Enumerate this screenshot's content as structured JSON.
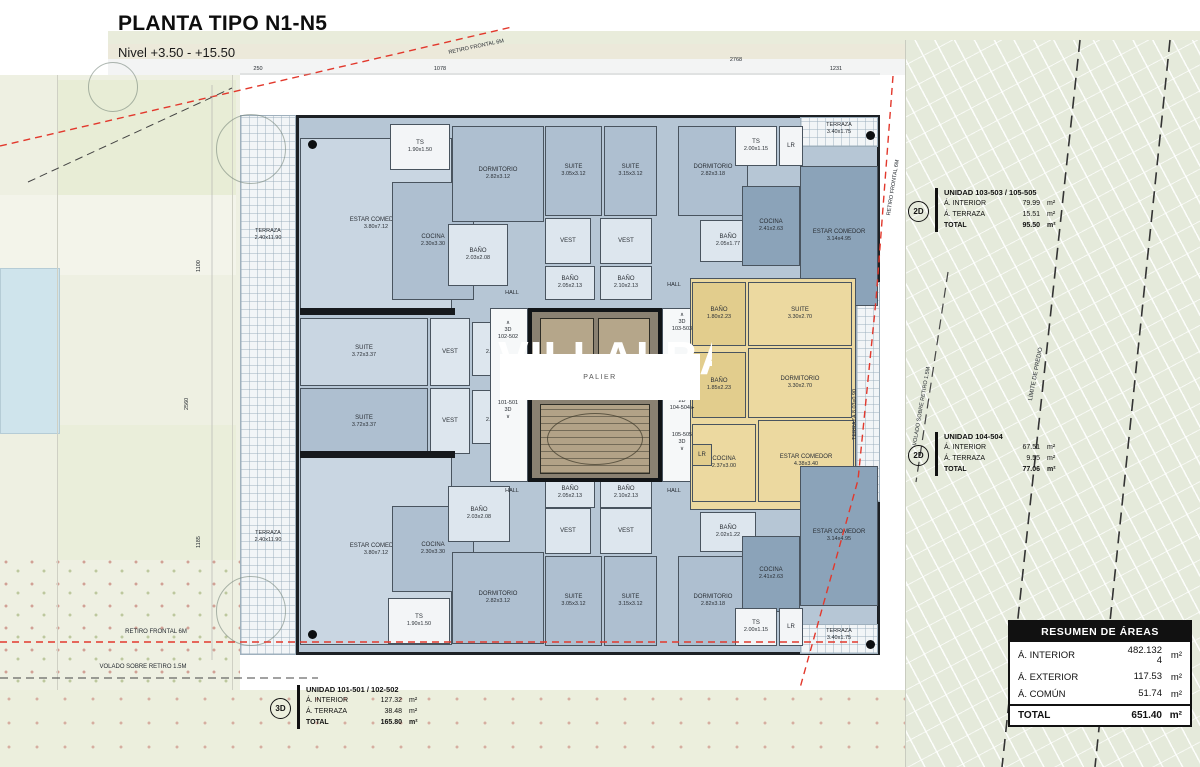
{
  "title": "PLANTA TIPO N1-N5",
  "subtitle": "Nivel +3.50 - +15.50",
  "watermark": "VILLALBA",
  "colors": {
    "fills": {
      "lb": "#c9d6e2",
      "mb": "#aebfd0",
      "db": "#8ba3b9",
      "wb": "#dde6ee",
      "yl": "#ecd9a0",
      "yd": "#e2cd8d",
      "wh": "#f3f5f7",
      "ht": "#f6f8f9"
    },
    "red_setback": "#e2382c",
    "wall": "#1d2125",
    "yellow_unit": "#ecd9a0",
    "blue_unit": "#aebfd0"
  },
  "core": {
    "elev1": "A01",
    "elev2": "A02",
    "palier": "PALIER"
  },
  "plan": {
    "terraces": [
      [
        240,
        115,
        56,
        540
      ],
      [
        800,
        117,
        78,
        30
      ],
      [
        800,
        624,
        78,
        30
      ],
      [
        856,
        282,
        24,
        220
      ]
    ],
    "rooms": [
      [
        300,
        138,
        152,
        172,
        "lb",
        "ESTAR COMEDOR",
        "3.80x7.12"
      ],
      [
        390,
        124,
        60,
        46,
        "wh",
        "TS",
        "1.90x1.50"
      ],
      [
        392,
        182,
        82,
        118,
        "mb",
        "COCINA",
        "2.30x3.30"
      ],
      [
        452,
        126,
        92,
        96,
        "mb",
        "DORMITORIO",
        "2.82x3.12"
      ],
      [
        448,
        224,
        60,
        62,
        "wb",
        "BAÑO",
        "2.03x2.08"
      ],
      [
        545,
        126,
        57,
        90,
        "mb",
        "SUITE",
        "3.05x3.12"
      ],
      [
        604,
        126,
        53,
        90,
        "mb",
        "SUITE",
        "3.15x3.12"
      ],
      [
        678,
        126,
        70,
        90,
        "mb",
        "DORMITORIO",
        "2.82x3.18"
      ],
      [
        545,
        218,
        46,
        46,
        "wb",
        "VEST",
        ""
      ],
      [
        600,
        218,
        52,
        46,
        "wb",
        "VEST",
        ""
      ],
      [
        545,
        266,
        50,
        34,
        "wb",
        "BAÑO",
        "2.05x2.13"
      ],
      [
        600,
        266,
        52,
        34,
        "wb",
        "BAÑO",
        "2.10x2.13"
      ],
      [
        700,
        220,
        56,
        42,
        "wb",
        "BAÑO",
        "2.05x1.77"
      ],
      [
        735,
        126,
        42,
        40,
        "wh",
        "TS",
        "2.00x1.15"
      ],
      [
        779,
        126,
        24,
        40,
        "wh",
        "LR",
        ""
      ],
      [
        742,
        186,
        58,
        80,
        "db",
        "COCINA",
        "2.41x2.63"
      ],
      [
        800,
        166,
        78,
        140,
        "db",
        "ESTAR COMEDOR",
        "3.14x4.95"
      ],
      [
        300,
        318,
        128,
        68,
        "lb",
        "SUITE",
        "3.72x3.37"
      ],
      [
        300,
        388,
        128,
        68,
        "mb",
        "SUITE",
        "3.72x3.37"
      ],
      [
        430,
        318,
        40,
        68,
        "wb",
        "VEST",
        ""
      ],
      [
        430,
        388,
        40,
        66,
        "wb",
        "VEST",
        ""
      ],
      [
        472,
        322,
        52,
        54,
        "wb",
        "BAÑO",
        "2.23x2.17"
      ],
      [
        472,
        390,
        52,
        54,
        "wb",
        "BAÑO",
        "2.23x2.17"
      ],
      [
        490,
        308,
        38,
        174,
        "ht",
        "",
        ""
      ],
      [
        662,
        308,
        30,
        174,
        "ht",
        "",
        ""
      ],
      [
        690,
        278,
        166,
        232,
        "yl",
        "",
        ""
      ],
      [
        692,
        282,
        54,
        64,
        "yd",
        "BAÑO",
        "1.80x2.23"
      ],
      [
        748,
        282,
        104,
        64,
        "yl",
        "SUITE",
        "3.30x2.70"
      ],
      [
        692,
        352,
        54,
        66,
        "yd",
        "BAÑO",
        "1.85x2.23"
      ],
      [
        748,
        348,
        104,
        70,
        "yl",
        "DORMITORIO",
        "3.30x2.70"
      ],
      [
        692,
        424,
        64,
        78,
        "yl",
        "COCINA",
        "2.37x3.00"
      ],
      [
        758,
        420,
        96,
        82,
        "yl",
        "ESTAR COMEDOR",
        "4.38x3.40"
      ],
      [
        692,
        444,
        20,
        22,
        "yd",
        "LR",
        ""
      ],
      [
        300,
        455,
        152,
        190,
        "lb",
        "ESTAR COMEDOR",
        "3.80x7.12"
      ],
      [
        392,
        506,
        82,
        86,
        "mb",
        "COCINA",
        "2.30x3.30"
      ],
      [
        448,
        486,
        62,
        56,
        "wb",
        "BAÑO",
        "2.03x2.08"
      ],
      [
        388,
        598,
        62,
        46,
        "wh",
        "TS",
        "1.90x1.50"
      ],
      [
        452,
        552,
        92,
        92,
        "mb",
        "DORMITORIO",
        "2.82x3.12"
      ],
      [
        545,
        556,
        57,
        90,
        "mb",
        "SUITE",
        "3.05x3.12"
      ],
      [
        604,
        556,
        53,
        90,
        "mb",
        "SUITE",
        "3.15x3.12"
      ],
      [
        678,
        556,
        70,
        90,
        "mb",
        "DORMITORIO",
        "2.82x3.18"
      ],
      [
        545,
        508,
        46,
        46,
        "wb",
        "VEST",
        ""
      ],
      [
        600,
        508,
        52,
        46,
        "wb",
        "VEST",
        ""
      ],
      [
        545,
        478,
        50,
        30,
        "wb",
        "BAÑO",
        "2.05x2.13"
      ],
      [
        600,
        478,
        52,
        30,
        "wb",
        "BAÑO",
        "2.10x2.13"
      ],
      [
        700,
        512,
        56,
        40,
        "wb",
        "BAÑO",
        "2.02x1.22"
      ],
      [
        742,
        536,
        58,
        76,
        "db",
        "COCINA",
        "2.41x2.63"
      ],
      [
        735,
        608,
        42,
        38,
        "wh",
        "TS",
        "2.00x1.15"
      ],
      [
        779,
        608,
        24,
        38,
        "wh",
        "LR",
        ""
      ],
      [
        800,
        466,
        78,
        140,
        "db",
        "ESTAR COMEDOR",
        "3.14x4.95"
      ]
    ],
    "bars": [
      [
        300,
        308,
        155,
        7
      ],
      [
        300,
        451,
        155,
        7
      ]
    ],
    "dots": [
      [
        308,
        140
      ],
      [
        308,
        630
      ],
      [
        866,
        131
      ],
      [
        866,
        640
      ]
    ],
    "trees": [
      [
        250,
        148,
        34
      ],
      [
        250,
        610,
        34
      ],
      [
        112,
        86,
        24
      ]
    ],
    "labels": [
      [
        "TERRAZA\n2.40x11.90",
        238,
        228,
        60,
        5.5,
        0
      ],
      [
        "TERRAZA\n2.40x11.90",
        238,
        530,
        60,
        5.5,
        0
      ],
      [
        "TERRAZA\n3.40x1.75",
        802,
        122,
        74,
        5.5,
        0
      ],
      [
        "TERRAZA\n3.40x1.75",
        802,
        628,
        74,
        5.5,
        0
      ],
      [
        "HALL",
        494,
        290,
        36,
        5.5,
        0
      ],
      [
        "HALL",
        656,
        282,
        36,
        5.5,
        0
      ],
      [
        "HALL",
        494,
        488,
        36,
        5.5,
        0
      ],
      [
        "HALL",
        656,
        488,
        36,
        5.5,
        0
      ],
      [
        "∧\n3D\n102-502",
        486,
        320,
        44,
        5.5,
        0
      ],
      [
        "101-501\n3D\n∨",
        486,
        400,
        44,
        5.5,
        0
      ],
      [
        "∧\n3D\n103-503",
        660,
        312,
        44,
        5.5,
        0
      ],
      [
        "2D\n104-504 ▸",
        656,
        398,
        52,
        5.5,
        0
      ],
      [
        "105-505\n3D\n∨",
        660,
        432,
        44,
        5.5,
        0
      ],
      [
        "RETIRO FRONTAL 6M",
        96,
        629,
        120,
        6,
        0
      ],
      [
        "VOLADO SOBRE RETIRO 1.5M",
        58,
        664,
        170,
        6,
        0
      ],
      [
        "RETIRO FRONTAL 6M",
        886,
        215,
        0,
        5.5,
        -81
      ],
      [
        "VOLADO SOBRE RETIRO 1.5M",
        912,
        445,
        0,
        5.5,
        -80
      ],
      [
        "LÍMITE DE PREDIO",
        1028,
        400,
        0,
        6,
        -79
      ],
      [
        "TERRAZA  8.03x0.90",
        852,
        440,
        0,
        5.5,
        -90
      ],
      [
        "RETIRO FRONTAL 6M",
        448,
        50,
        0,
        5.5,
        -12
      ],
      [
        "250",
        244,
        66,
        28,
        5.5,
        0
      ],
      [
        "1078",
        424,
        66,
        32,
        5.5,
        0
      ],
      [
        "2768",
        720,
        57,
        32,
        5.5,
        0
      ],
      [
        "1231",
        820,
        66,
        32,
        5.5,
        0
      ],
      [
        "1100",
        196,
        272,
        0,
        5.5,
        -90
      ],
      [
        "2560",
        184,
        410,
        0,
        5.5,
        -90
      ],
      [
        "1185",
        196,
        548,
        0,
        5.5,
        -90
      ]
    ],
    "lines": [
      [
        "0,146 512,27",
        "#e2382c",
        1.4,
        "7,5"
      ],
      [
        "893,76 876,300 858,480 800,688",
        "#e2382c",
        1.4,
        "7,5"
      ],
      [
        "0,642 858,642",
        "#e2382c",
        1.4,
        "7,5"
      ],
      [
        "0,678 318,678",
        "#444444",
        1,
        "8,5"
      ],
      [
        "28,182 232,88",
        "#444444",
        1,
        "8,5"
      ],
      [
        "948,272 916,482",
        "#444444",
        1.2,
        "10,6"
      ],
      [
        "1080,40 1002,767",
        "#333333",
        1.6,
        "12,7"
      ],
      [
        "1170,40 1095,767",
        "#333333",
        1.6,
        "12,7"
      ],
      [
        "240,74 880,74",
        "#aaaaaa",
        0.6,
        ""
      ],
      [
        "212,85 212,660",
        "#aaaaaa",
        0.6,
        ""
      ]
    ]
  },
  "unit_tables": [
    {
      "badge": "3D",
      "title": "UNIDAD 101-501 / 102-502",
      "rows": [
        [
          "Á. INTERIOR",
          "127.32",
          "m²"
        ],
        [
          "Á. TERRAZA",
          "38.48",
          "m²"
        ],
        [
          "TOTAL",
          "165.80",
          "m²"
        ]
      ]
    },
    {
      "badge": "2D",
      "title": "UNIDAD 103-503 / 105-505",
      "rows": [
        [
          "Á. INTERIOR",
          "79.99",
          "m²"
        ],
        [
          "Á. TERRAZA",
          "15.51",
          "m²"
        ],
        [
          "TOTAL",
          "95.50",
          "m²"
        ]
      ]
    },
    {
      "badge": "2D",
      "title": "UNIDAD 104-504",
      "rows": [
        [
          "Á. INTERIOR",
          "67.51",
          "m²"
        ],
        [
          "Á. TERRAZA",
          "9.55",
          "m²"
        ],
        [
          "TOTAL",
          "77.06",
          "m²"
        ]
      ]
    }
  ],
  "resumen": {
    "title": "RESUMEN DE ÁREAS",
    "rows": [
      [
        "Á. INTERIOR",
        "482.132\n4",
        "m²"
      ],
      [
        "Á. EXTERIOR",
        "117.53",
        "m²"
      ],
      [
        "Á. COMÚN",
        "51.74",
        "m²"
      ]
    ],
    "total": [
      "TOTAL",
      "651.40",
      "m²"
    ]
  }
}
